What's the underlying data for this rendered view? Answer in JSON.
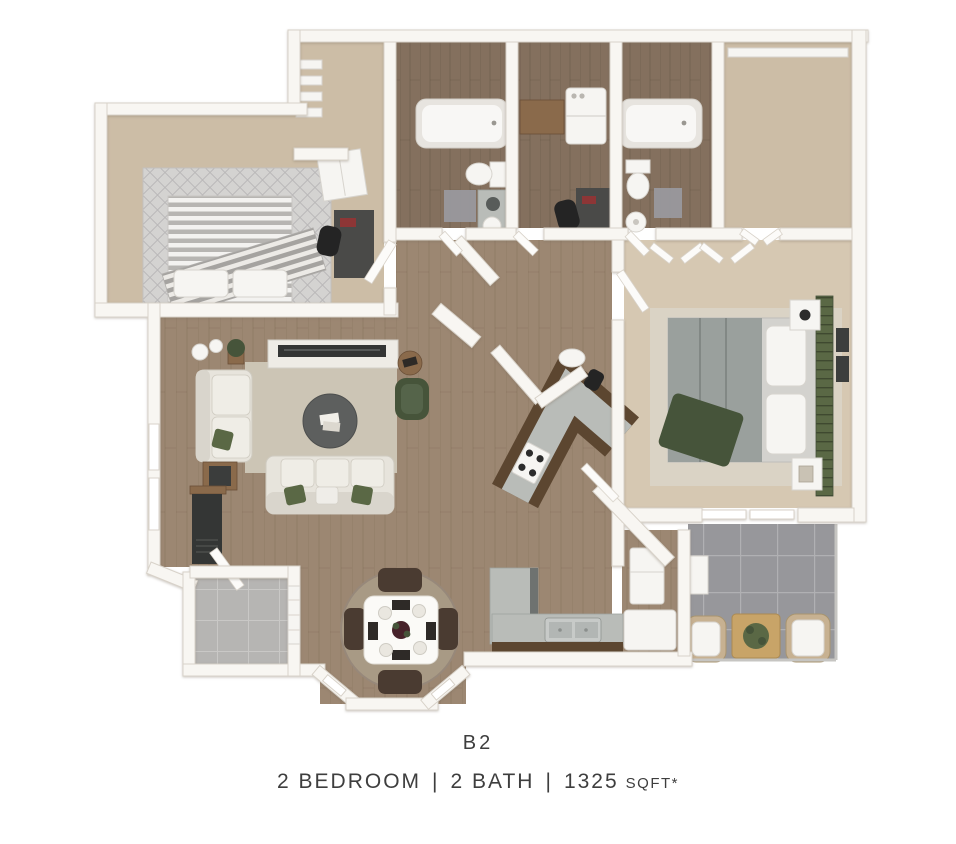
{
  "caption": {
    "plan_code": "B2",
    "bedrooms": "2 BEDROOM",
    "separator": "|",
    "baths": "2 BATH",
    "area_value": "1325",
    "area_unit": "SQFT*"
  },
  "colors": {
    "wall": "#f8f6f2",
    "wallEdge": "#d8d2c9",
    "wood": "#9c8772",
    "woodDark": "#84705e",
    "carpet": "#ccbda6",
    "carpet2": "#d6c8b2",
    "rugGray": "#d4d3d1",
    "rugLattice": "#b9b7b8",
    "rugBeige": "#dad3c5",
    "rugLiving": "#ccc5b5",
    "rugDining": "#a89a85",
    "tileLight": "#b6b5b3",
    "grout": "#c9c8c6",
    "tileDark": "#97979b",
    "groutDark": "#b0b0b3",
    "sofa": "#e7e4dc",
    "sofaTrim": "#cfcbc1",
    "cushion": "#efedE6",
    "green": "#5a6845",
    "greenDark": "#46543a",
    "tableDark": "#5d5f5e",
    "tvDark": "#333534",
    "woodFurn": "#8a6a4b",
    "barWood": "#5c4630",
    "counter": "#b9bcb8",
    "steel": "#c7cac8",
    "fixture": "#f6f5f2",
    "fixtureRim": "#d7d4ce",
    "mat": "#9a9aa1",
    "deskDark": "#4a4a48",
    "fire": "#343635",
    "wicker": "#c7b191",
    "text": "#3e3e3e"
  }
}
